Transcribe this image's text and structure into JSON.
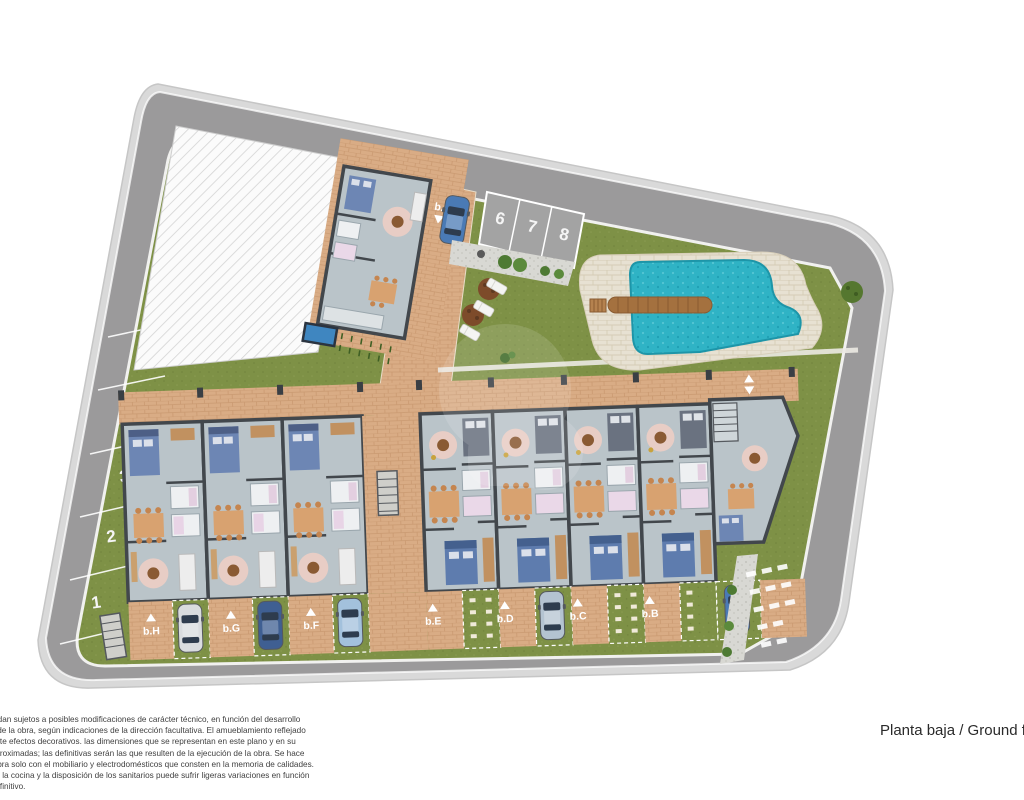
{
  "title": "Planta baja / Ground f",
  "parking": [
    "1",
    "2",
    "3",
    "4",
    "5",
    "6",
    "7",
    "8"
  ],
  "row_units": [
    "b.H",
    "b.G",
    "b.F",
    "b.E",
    "b.D",
    "b.C",
    "b.B"
  ],
  "top_unit": "b.I",
  "disclaimer": [
    "quedan sujetos a posibles modificaciones de carácter técnico, en función del desarrollo",
    "o y de la obra, según indicaciones de la dirección facultativa. El amueblamiento reflejado",
    "mente efectos decorativos. las dimensiones que se representan en este plano y en su",
    "n aproximadas; las definitivas serán las que resulten de la ejecución de la obra. Se hace",
    "la obra solo con el mobiliario y electrodomésticos que consten en la memoria de calidades.",
    "o de la cocina y la disposición de los sanitarios puede sufrir ligeras variaciones en función",
    "e definitivo."
  ],
  "colors": {
    "road": "#9b9a9b",
    "sidewalk": "#d9d9d9",
    "grass": "#7e9146",
    "paving": "#d9ac85",
    "pool_water": "#2fb3c5",
    "pool_deck": "#e7e1d2",
    "floor": "#bac4c9",
    "wall": "#42474c",
    "wood": "#a4713f"
  }
}
